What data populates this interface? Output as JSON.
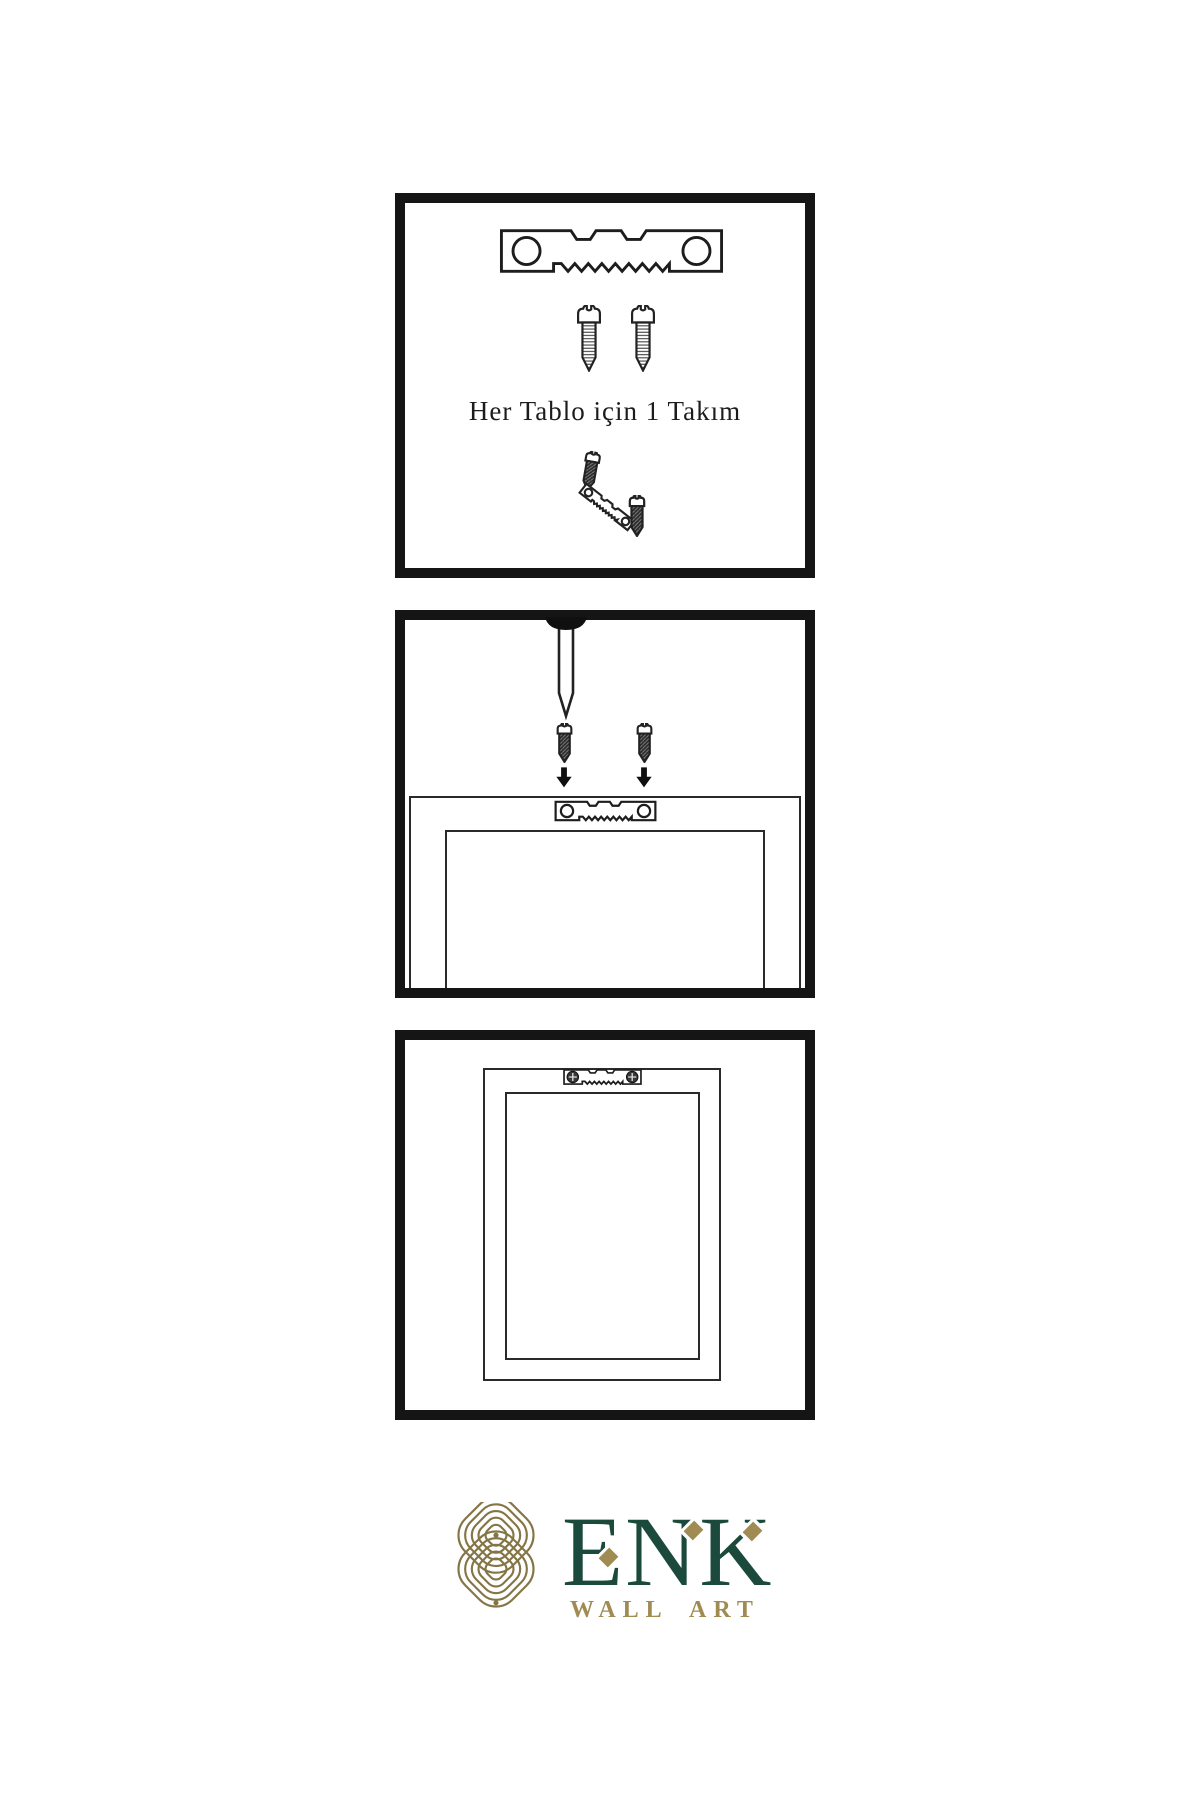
{
  "page": {
    "background": "#ffffff",
    "ink": "#1a1a1a"
  },
  "panels": {
    "hardware_kit": {
      "caption": "Her Tablo için 1 Takım",
      "contents": [
        "sawtooth-hanger",
        "screw",
        "screw",
        "screw-driving-into-tilted-hanger"
      ]
    },
    "installation": {
      "contents": [
        "wall-nail",
        "screw",
        "screw",
        "down-arrow",
        "down-arrow",
        "frame-back-with-sawtooth-hanger"
      ]
    },
    "mounted": {
      "contents": [
        "frame-back-with-hanger-screwed-in"
      ]
    }
  },
  "brand": {
    "name": "ENK",
    "subtitle": "WALL ART",
    "colors": {
      "green": "#1b4a3c",
      "gold": "#a08b52",
      "knot_gold": "#857545"
    }
  },
  "icons": {
    "sawtooth_hanger_icon": "svg-shape",
    "screw_icon": "svg-shape",
    "dark_screw_icon": "svg-shape",
    "nail_icon": "svg-shape",
    "arrow_down_icon": "▼",
    "phillips_screw_head_icon": "⊕",
    "knot_logo_icon": "svg-shape",
    "diamond_accent_icon": "♦"
  }
}
